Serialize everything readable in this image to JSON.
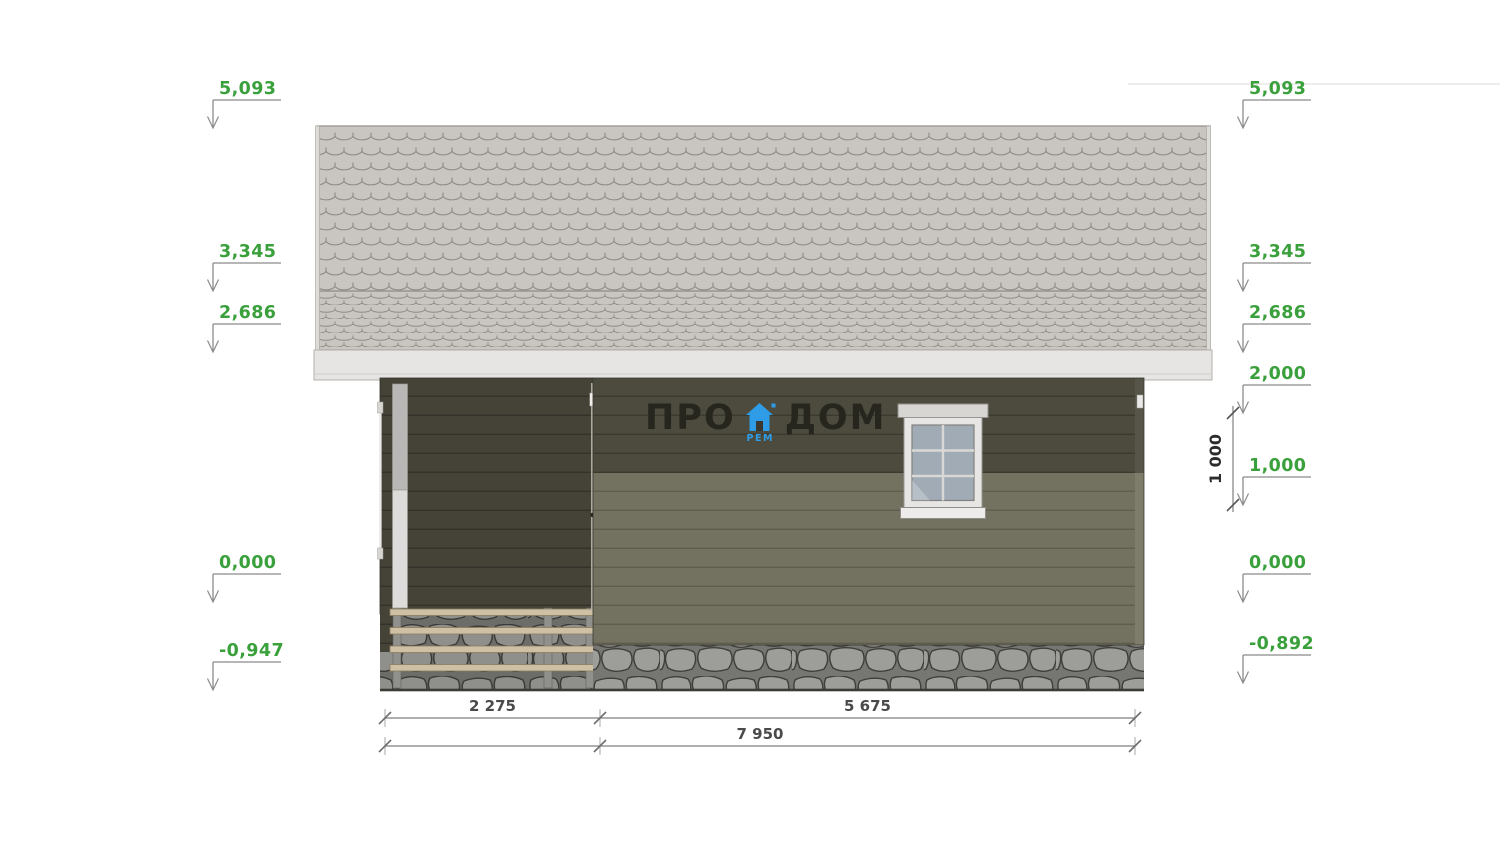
{
  "logo": {
    "word_left": "ПРО",
    "word_right": "ДОМ",
    "subtext": "РЕМ"
  },
  "levels": {
    "left_x": 213,
    "right_x": 1243,
    "left": [
      {
        "label": "5,093",
        "y": 128
      },
      {
        "label": "3,345",
        "y": 291
      },
      {
        "label": "2,686",
        "y": 352
      },
      {
        "label": "0,000",
        "y": 602
      },
      {
        "label": "-0,947",
        "y": 690
      }
    ],
    "right": [
      {
        "label": "5,093",
        "y": 128
      },
      {
        "label": "3,345",
        "y": 291
      },
      {
        "label": "2,686",
        "y": 352
      },
      {
        "label": "2,000",
        "y": 413
      },
      {
        "label": "1,000",
        "y": 505
      },
      {
        "label": "0,000",
        "y": 602
      },
      {
        "label": "-0,892",
        "y": 683
      }
    ]
  },
  "vertical_dimension": {
    "label": "1 000",
    "x": 1233,
    "y_top": 413,
    "y_bottom": 505
  },
  "bottom_dimensions": {
    "rows": [
      {
        "y": 718,
        "ticks": [
          385,
          600,
          1135
        ],
        "segments": [
          {
            "label": "2 275",
            "x1": 385,
            "x2": 600
          },
          {
            "label": "5 675",
            "x1": 600,
            "x2": 1135
          }
        ]
      },
      {
        "y": 746,
        "ticks": [
          385,
          600,
          1135
        ],
        "segments": [
          {
            "label": "7 950",
            "x1": 385,
            "x2": 1135
          }
        ]
      }
    ]
  },
  "colors": {
    "roof_shingle": "#c9c5c0",
    "roof_line": "#8e8a84",
    "roof_edge": "#dcdbd8",
    "fascia": "#e6e5e3",
    "fascia_line": "#b3b0ab",
    "siding_dark": "#454337",
    "siding_dark_line": "#34322a",
    "wall_upper": "#4c4b3e",
    "wall_upper_line": "#3b3a2f",
    "wall_lower": "#73715f",
    "wall_lower_line": "#5f5d4d",
    "stone_bg": "#767672",
    "stone_fill": "#9d9d9a",
    "stone_line": "#3f3e39",
    "beam": "#cec0a5",
    "beam_edge": "#8a7c60",
    "post": "#90908d",
    "column_top": "#b9b8b6",
    "column_bottom": "#dddcda",
    "window_frame": "#e7e6e4",
    "window_trim": "#d8d6d3",
    "glass": "#a0abb5",
    "glass_line": "#d9d8d5",
    "accent_green": "#3aa03c",
    "leader_gray": "#8b8b8b",
    "dim_text": "#4a4a4a",
    "logo_text": "#26261f",
    "logo_blue": "#2e9ce7"
  }
}
